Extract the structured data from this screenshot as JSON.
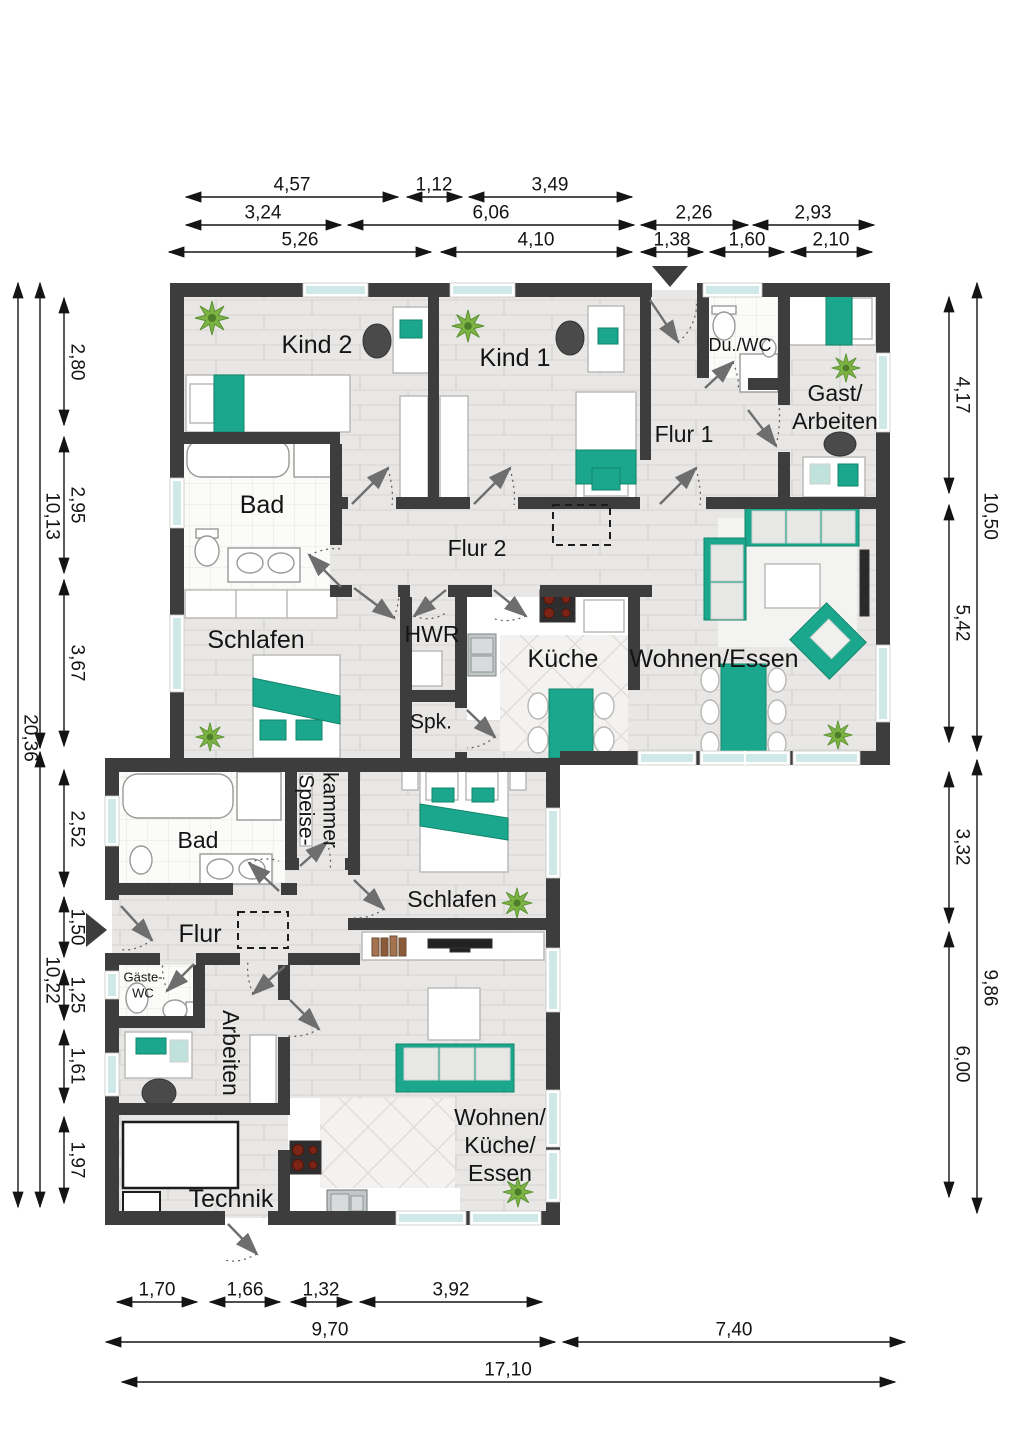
{
  "rooms": {
    "upper": {
      "kind2": "Kind 2",
      "kind1": "Kind 1",
      "du_wc": "Du./WC",
      "gast_arbeiten": [
        "Gast/",
        "Arbeiten"
      ],
      "flur1": "Flur 1",
      "bad": "Bad",
      "flur2": "Flur 2",
      "schlafen": "Schlafen",
      "hwr": "HWR",
      "spk": "Spk.",
      "kueche": "Küche",
      "wohnen_essen": "Wohnen/Essen"
    },
    "lower": {
      "bad": "Bad",
      "speisekammer": [
        "Speise-",
        "kammer"
      ],
      "schlafen": "Schlafen",
      "flur": "Flur",
      "gaeste_wc": [
        "Gäste-",
        "WC"
      ],
      "arbeiten": "Arbeiten",
      "technik": "Technik",
      "wohnen_kueche_essen": [
        "Wohnen/",
        "Küche/",
        "Essen"
      ]
    }
  },
  "dimensions": {
    "top": {
      "row1": [
        "4,57",
        "1,12",
        "3,49"
      ],
      "row2": [
        "3,24",
        "6,06",
        "2,26",
        "2,93"
      ],
      "row3": [
        "5,26",
        "4,10",
        "1,38",
        "1,60",
        "2,10"
      ]
    },
    "left": {
      "outer": "20,36",
      "middle": [
        "10,13",
        "10,22"
      ],
      "inner": [
        "2,80",
        "2,95",
        "3,67",
        "2,52",
        "1,50",
        "1,25",
        "1,61",
        "1,97"
      ]
    },
    "right": {
      "outer": [
        "10,50",
        "9,86"
      ],
      "inner": [
        "4,17",
        "5,42",
        "3,32",
        "6,00"
      ]
    },
    "bottom": {
      "row1": [
        "1,70",
        "1,66",
        "1,32",
        "3,92"
      ],
      "row2": [
        "9,70",
        "7,40"
      ],
      "row3": "17,10"
    }
  },
  "colors": {
    "wall": "#3d3d3d",
    "accent_teal": "#1ba78e",
    "window_glass": "#cfe9e8",
    "plant_green": "#7cb342",
    "dimension_text": "#141414"
  }
}
